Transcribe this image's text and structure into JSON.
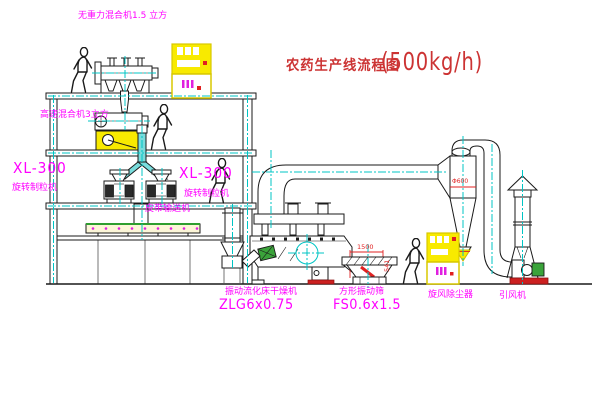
{
  "title": {
    "name": "农药生产线流程图",
    "capacity": "(500kg/h)"
  },
  "labels": {
    "gravity_free_mixer": "无重力混合机1.5 立方",
    "high_speed_mixer": "高速混合机3立方",
    "granulator_left_model": "XL-300",
    "granulator_left_name": "旋转制粒机",
    "granulator_right_model": "XL-300",
    "granulator_right_name": "旋转制粒机",
    "belt_conveyor": "皮带输送机",
    "dryer_name": "振动流化床干燥机",
    "dryer_model": "ZLG6x0.75",
    "sieve_name": "方形振动筛",
    "sieve_model": "FS0.6x1.5",
    "cyclone": "旋风除尘器",
    "fan": "引风机"
  },
  "dimensions": {
    "sieve_length": "1500",
    "sieve_height": "541",
    "cyclone_diameter": "Φ600"
  },
  "colors": {
    "background": "#ffffff",
    "line": "#1a1a1a",
    "centerline": "#00c4c4",
    "label_magenta": "#ff00ff",
    "title_red": "#cc3333",
    "cabinet_yellow": "#f8ea00",
    "accent_red": "#e02222",
    "accent_green": "#3aa33a",
    "pipe_cyan_fill": "#79dcdc"
  }
}
